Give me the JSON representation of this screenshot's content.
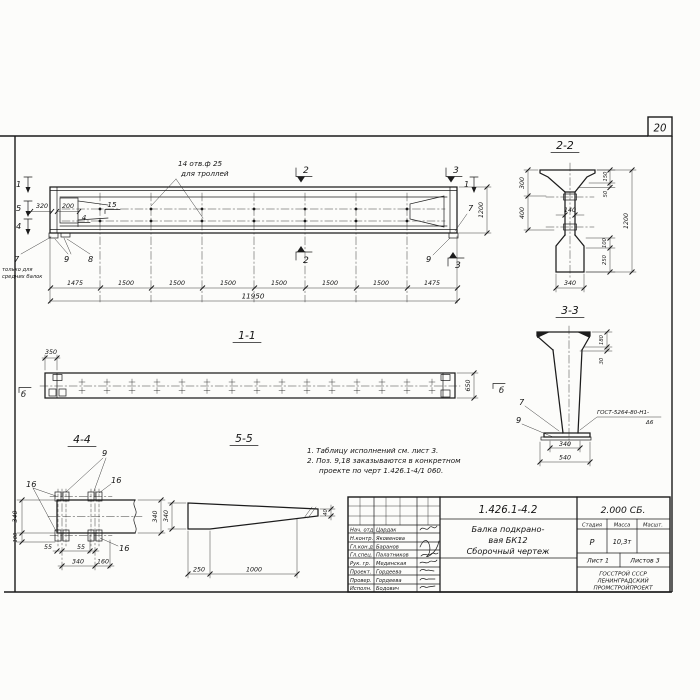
{
  "sheet": {
    "number": "20"
  },
  "elevation": {
    "callout_line1": "14 отв.ф 25",
    "callout_line2": "для троллей",
    "marks": {
      "left1": "1",
      "left5": "5",
      "left4": "4",
      "top2": "2",
      "bottom2": "2",
      "top3": "3",
      "bottom3": "3",
      "right1": "1"
    },
    "labels": {
      "d320": "320",
      "d200": "200",
      "p15": "15",
      "p4": "4",
      "p7_left": "7",
      "p9_left": "9",
      "p8": "8",
      "p9_right": "9",
      "p7_right": "7"
    },
    "note_line1": "только для",
    "note_line2": "средних балок",
    "dims": [
      "1475",
      "1500",
      "1500",
      "1500",
      "1500",
      "1500",
      "1500",
      "1475"
    ],
    "total": "11950",
    "height": "1200"
  },
  "section22": {
    "title": "2-2",
    "d300": "300",
    "d400": "400",
    "d140": "140",
    "d150": "150",
    "d50": "50",
    "d1200": "1200",
    "d100": "100",
    "d250": "250",
    "d340": "340"
  },
  "section33": {
    "title": "3-3",
    "d180": "180",
    "d30": "30",
    "p7": "7",
    "p9": "9",
    "weld1": "ГОСТ-5264-80-Н1-",
    "weld2": "Δ6",
    "d340": "340",
    "d540": "540"
  },
  "view11": {
    "title": "1-1",
    "d350": "350",
    "d650": "650",
    "mark_left": "б",
    "mark_right": "б"
  },
  "view44": {
    "title": "4-4",
    "p9": "9",
    "p16a": "16",
    "p16b": "16",
    "p16c": "16",
    "d340_left": "340",
    "d100": "100",
    "d55a": "55",
    "d55b": "55",
    "d340_bottom": "340",
    "d160": "160",
    "d340_right": "340"
  },
  "view55": {
    "title": "5-5",
    "d340": "340",
    "d40": "40",
    "d250": "250",
    "d1000": "1000"
  },
  "notes": {
    "line1": "1. Таблицу исполнений см. лист 3.",
    "line2": "2. Поз. 9,18 заказываются в конкретном",
    "line3": "проекте по черт 1.426.1-4/1 060."
  },
  "title_block": {
    "doc_number": "1.426.1-4.2",
    "doc_code": "2.000 СБ.",
    "name_line1": "Балка подкрано-",
    "name_line2": "вая БК12",
    "name_line3": "Сборочный чертеж",
    "col_stage": "Стадия",
    "col_mass": "Масса",
    "col_scale": "Масшт.",
    "stage": "Р",
    "mass": "10,3т",
    "sheet_label": "Лист 1",
    "sheets_label": "Листов 3",
    "org1": "ГОССТРОЙ СССР",
    "org2": "ЛЕНИНГРАДСКИЙ",
    "org3": "ПРОМСТРОЙПРОЕКТ",
    "signatures": [
      {
        "role": "Нач. отд",
        "name": "Цардак"
      },
      {
        "role": "Н.контр.",
        "name": "Яковенова"
      },
      {
        "role": "Гл.кон.д",
        "name": "Баранов"
      },
      {
        "role": "Гл.спец.",
        "name": "Палатников"
      },
      {
        "role": "Рук. гр.",
        "name": "Мединская"
      },
      {
        "role": "Проект.",
        "name": "Гордеева"
      },
      {
        "role": "Провер.",
        "name": "Гордеева"
      },
      {
        "role": "Исполн.",
        "name": "Бодович"
      }
    ]
  }
}
